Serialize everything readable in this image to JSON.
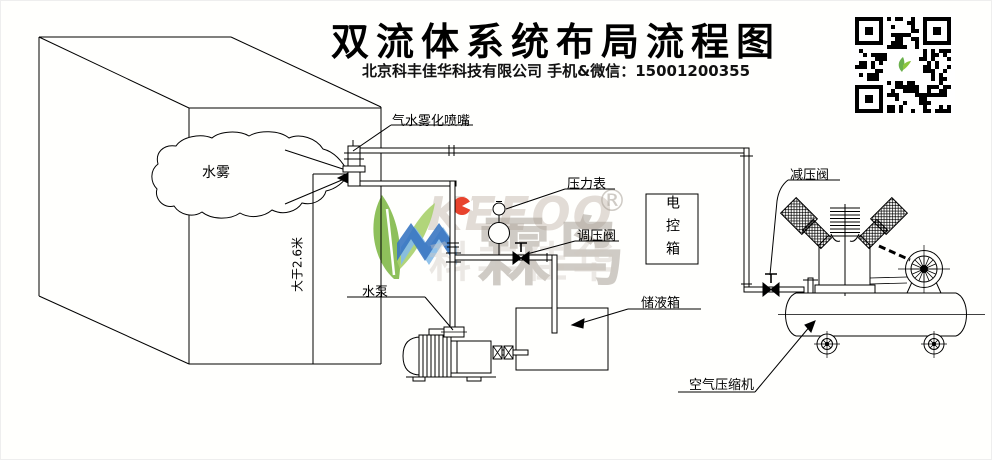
{
  "header": {
    "title": "双流体系统布局流程图",
    "subtitle": "北京科丰佳华科技有限公司 手机&微信：15001200355"
  },
  "watermark": {
    "letters": "KEEOO",
    "brand_cn": "霖鸟",
    "registered": "®",
    "company_faint": "科丰佳华",
    "colors": {
      "green": "#8cc63e",
      "blue": "#3a77c2",
      "blue_light": "#85bbe8",
      "red": "#e8432d",
      "gray": "#aaa39b"
    }
  },
  "diagram": {
    "labels": {
      "mist": "水雾",
      "nozzle": "气水雾化喷嘴",
      "height_dim": "大于2.6米",
      "water_pump": "水泵",
      "pressure_gauge": "压力表",
      "regulating_valve": "调压阀",
      "control_box": "电控箱",
      "storage_tank": "储液箱",
      "reducing_valve": "减压阀",
      "air_compressor": "空气压缩机"
    },
    "line_color": "#000000",
    "background": "#ffffff"
  }
}
